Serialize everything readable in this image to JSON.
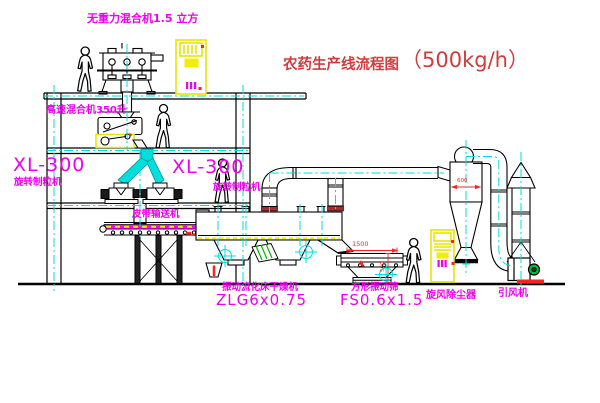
{
  "title": {
    "text": "农药生产线流程图",
    "capacity": "（500kg/h）"
  },
  "equipment_labels": {
    "gravity_free_mixer": "无重力混合机1.5 立方",
    "high_speed_mixer": "高速混合机350升",
    "granulator_left": {
      "model": "XL-300",
      "name": "旋转制粒机"
    },
    "granulator_right": {
      "model": "XL-300",
      "name": "旋转制粒机"
    },
    "belt_conveyor": "皮带输送机",
    "fluid_bed_dryer": {
      "name": "振动流化床干燥机",
      "model": "ZLG6x0.75"
    },
    "square_vibrating_sieve": {
      "name": "方形振动筛",
      "model": "FS0.6x1.5"
    },
    "cyclone_dust_collector": "旋风除尘器",
    "induced_draft_fan": "引风机"
  },
  "dimensions": {
    "sieve_length": "1500",
    "cyclone_diameter": "600",
    "sieve_height": "500"
  },
  "colors": {
    "label_magenta": "#f000f0",
    "title_red": "#d43c3c",
    "dimension_red": "#ff2020",
    "centerline_cyan": "#00dede",
    "cabinet_yellow": "#ece800",
    "belt_magenta": "#ff00ff",
    "fan_motor_green": "#00c040",
    "machine_base_red": "#ff2020"
  }
}
